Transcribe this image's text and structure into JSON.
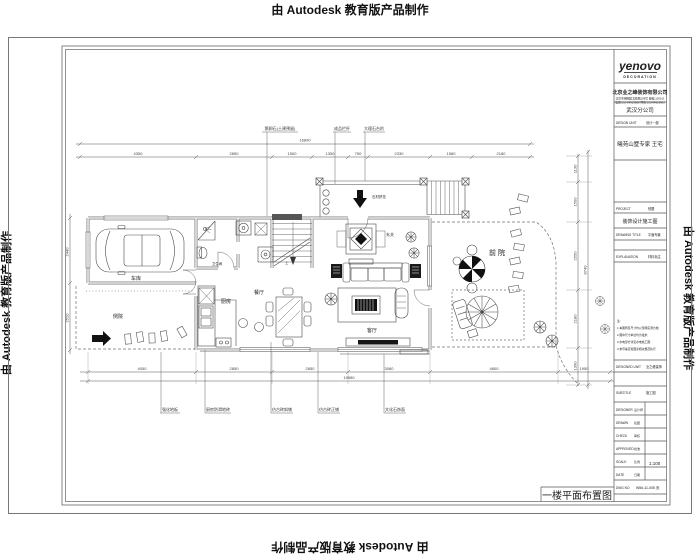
{
  "watermark": {
    "text": "由 Autodesk 教育版产品制作"
  },
  "title_block": {
    "logo_main": "yenovo",
    "logo_sub": "DECORATION",
    "company": "北京业之峰装饰有限公司",
    "address_line1": "北京市朝阳区北苑路198号 邮编:100101",
    "address_line2": "电话:010-84929988 传真:010-84929900",
    "branch": "武汉分公司",
    "design_unit_label": "DESIGN UNIT",
    "design_unit_value": "设计一部",
    "project_name": "曦苑山墅专家 王宅",
    "project_label": "PROJECT",
    "project_value": "别墅",
    "project_type": "装饰设计施工图",
    "drawing_title_label": "DRAWING TITLE",
    "drawing_title_value": "平面布置",
    "explanation_label": "EXPLANATION",
    "explanation_value": "材料标注",
    "notes": [
      "注:",
      "1.本图所有尺寸均以现场实测为准;",
      "2.图中尺寸单位均为毫米;",
      "3.水电部分详见水电施工图;",
      "4.未尽事宜按国家相关规范执行."
    ],
    "designed_unit_label": "DESIGNED UNIT",
    "designed_unit_value": "业之峰装饰",
    "subtitle_label": "SUBTITLE",
    "subtitle_value": "施工图",
    "sign_rows": [
      {
        "label": "DESIGNER",
        "value": "设计师"
      },
      {
        "label": "DRAWN",
        "value": "绘图"
      },
      {
        "label": "CHECK",
        "value": "审核"
      },
      {
        "label": "APPROVED",
        "value": "批准"
      },
      {
        "label": "SCALE",
        "value": "比例"
      },
      {
        "label": "DATE",
        "value": "日期"
      }
    ],
    "scale_value": "1:100",
    "dwg_no_label": "DWG NO",
    "dwg_no_value": "W5#-11-005 页"
  },
  "plan": {
    "title": "一楼平面布置图",
    "rooms": {
      "garage": "车库",
      "side_yard": "侧院",
      "bath": "卫生间",
      "kitchen": "厨房",
      "dining": "餐厅",
      "living": "客厅",
      "foyer": "玄关",
      "front_yard": "前院",
      "stair_up": "上"
    },
    "entry_note": "石材拼花",
    "callouts_top": [
      "鹅卵石(土建预留)",
      "成品栏杆",
      "大理石台阶"
    ],
    "callouts_bottom": [
      "强化地板",
      "厨房防滑地砖",
      "仿古砖斜铺",
      "仿古砖正铺",
      "文化石饰面"
    ],
    "dims": {
      "top_total": "16890",
      "top": [
        "4350",
        "2850",
        "1500",
        "1350",
        "750",
        "2330",
        "1580",
        "2180"
      ],
      "bottom": [
        "4050",
        "2850",
        "2850",
        "3080",
        "4800",
        "1950"
      ],
      "bottom_total": "19580",
      "left": [
        "2440",
        "2520"
      ],
      "right": [
        "1130",
        "1500",
        "2550",
        "2180",
        "1390"
      ],
      "right_total": "8740"
    }
  }
}
